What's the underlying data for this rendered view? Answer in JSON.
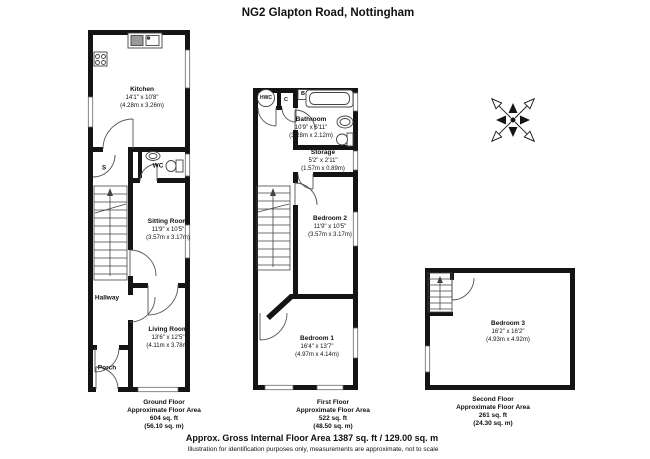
{
  "title": "NG2 Glapton Road, Nottingham",
  "colors": {
    "wall": "#141414",
    "background": "#ffffff"
  },
  "floors": {
    "ground": {
      "rooms": {
        "kitchen": {
          "name": "Kitchen",
          "dims": "14'1\" x 10'8\"",
          "metric": "(4.28m x 3.26m)"
        },
        "sitting_room": {
          "name": "Sitting Room",
          "dims": "11'9\" x 10'5\"",
          "metric": "(3.57m x 3.17m)"
        },
        "living_room": {
          "name": "Living Room",
          "dims": "13'6\" x 12'5\"",
          "metric": "(4.11m x 3.78m)"
        }
      },
      "labels": {
        "wc": "WC",
        "store": "S",
        "hallway": "Hallway",
        "porch": "Porch"
      },
      "footer": {
        "line1": "Ground Floor",
        "line2": "Approximate Floor Area",
        "line3": "604 sq. ft",
        "line4": "(56.10 sq. m)"
      }
    },
    "first": {
      "rooms": {
        "bathroom": {
          "name": "Bathroom",
          "dims": "10'9\" x 6'11\"",
          "metric": "(3.28m x 2.12m)"
        },
        "storage": {
          "name": "Storage",
          "dims": "5'2\" x 2'11\"",
          "metric": "(1.57m x 0.89m)"
        },
        "bedroom2": {
          "name": "Bedroom 2",
          "dims": "11'9\" x 10'5\"",
          "metric": "(3.57m x 3.17m)"
        },
        "bedroom1": {
          "name": "Bedroom 1",
          "dims": "16'4\" x 13'7\"",
          "metric": "(4.97m x 4.14m)"
        }
      },
      "labels": {
        "hwc": "HWC",
        "c": "C",
        "b": "B"
      },
      "footer": {
        "line1": "First Floor",
        "line2": "Approximate Floor Area",
        "line3": "522 sq. ft",
        "line4": "(48.50 sq. m)"
      }
    },
    "second": {
      "rooms": {
        "bedroom3": {
          "name": "Bedroom 3",
          "dims": "16'2\" x 16'2\"",
          "metric": "(4.93m x 4.92m)"
        }
      },
      "footer": {
        "line1": "Second Floor",
        "line2": "Approximate Floor Area",
        "line3": "261 sq. ft",
        "line4": "(24.30 sq. m)"
      }
    }
  },
  "footer": {
    "summary": "Approx. Gross Internal Floor Area 1387 sq. ft / 129.00 sq. m",
    "disclaimer": "Illustration for identification purposes only, measurements are approximate, not to scale"
  }
}
